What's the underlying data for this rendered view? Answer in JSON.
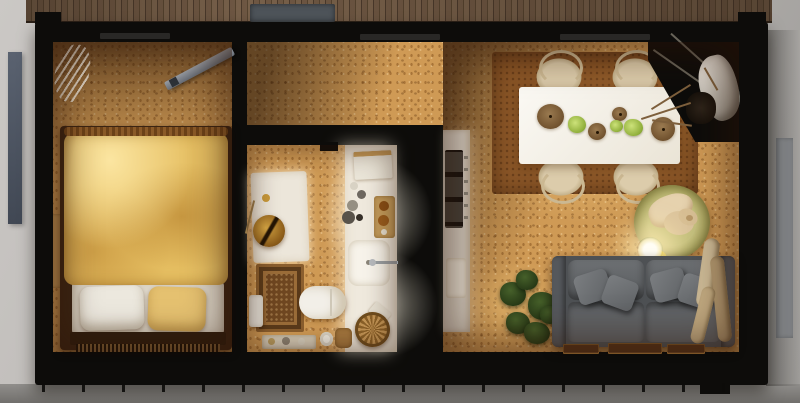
{
  "scene": {
    "type": "3d-floor-plan-top-down-render",
    "rooms": [
      {
        "id": "bedroom",
        "furniture": [
          "pampas-plant",
          "steel-beam",
          "nightstand",
          "double-bed",
          "duvet",
          "pillow-white",
          "pillow-yellow",
          "headboard",
          "slatted-bench"
        ]
      },
      {
        "id": "hallway",
        "furniture": []
      },
      {
        "id": "bathroom",
        "furniture": [
          "shower-vanity-panel",
          "gold-basin",
          "vanity-counter",
          "towel-stack",
          "accessory-jars",
          "bottle-tray",
          "sink",
          "faucet",
          "ornate-rug",
          "toilet",
          "pedal-bin",
          "soap-dish",
          "wicker-basket",
          "bath-bench",
          "paper-roll",
          "wicker-bin"
        ]
      },
      {
        "id": "living-dining",
        "furniture": [
          "kitchenette-counter",
          "cooktop",
          "kitchen-sink",
          "dining-rug",
          "dining-table",
          "wishbone-chairs",
          "bowls-and-greens",
          "dog-bed",
          "sleeping-dog",
          "floor-lamp",
          "sofa",
          "throw-pillows",
          "green-plant",
          "driftwood-decor",
          "dried-branches",
          "drapery",
          "floor-mats"
        ]
      }
    ],
    "exterior": [
      "wood-deck",
      "doormat",
      "fence-panel-left",
      "panel-right",
      "concrete-apron",
      "roof-batten-ticks"
    ]
  },
  "counts": {
    "dining_chairs": 4,
    "sofa_throw_pillows": 4,
    "table_items": 7,
    "floor_mats": 3
  },
  "palette": {
    "wall": "#0d0c0a",
    "floor": "#cf9a55",
    "rug": "#8a5627",
    "duvet": "#e6bf62",
    "sofa": "#4e5154",
    "gold": "#d9a945",
    "deck": "#63503e",
    "dogbed": "#b3ae6b",
    "ground": "#b8b5b2"
  },
  "bathroom": {
    "accessories": [
      {
        "name": "jar",
        "cls": "dot",
        "x": 350,
        "y": 182,
        "w": 8,
        "h": 8,
        "color": "#d8d2c4"
      },
      {
        "name": "jar",
        "cls": "dot",
        "x": 357,
        "y": 190,
        "w": 9,
        "h": 9,
        "color": "#6e6860"
      },
      {
        "name": "jar",
        "cls": "dot",
        "x": 347,
        "y": 200,
        "w": 11,
        "h": 11,
        "color": "#958f82"
      },
      {
        "name": "jar",
        "cls": "dot",
        "x": 342,
        "y": 211,
        "w": 13,
        "h": 13,
        "color": "#59534a"
      },
      {
        "name": "jar",
        "cls": "dot",
        "x": 356,
        "y": 214,
        "w": 7,
        "h": 7,
        "color": "#352f28"
      }
    ],
    "bench_items": [
      {
        "name": "bottle",
        "cls": "dot",
        "x": 268,
        "y": 338,
        "w": 7,
        "h": 7,
        "color": "#b89c60"
      },
      {
        "name": "bottle",
        "cls": "dot",
        "x": 282,
        "y": 337,
        "w": 8,
        "h": 8,
        "color": "#8a8072"
      },
      {
        "name": "bottle",
        "cls": "dot",
        "x": 298,
        "y": 338,
        "w": 7,
        "h": 7,
        "color": "#d8d2c2"
      }
    ]
  },
  "dining": {
    "chairs": [
      {
        "name": "wishbone-chair",
        "cls": "chair chair-t",
        "x": 536,
        "y": 58,
        "w": 46,
        "h": 38
      },
      {
        "name": "wishbone-chair",
        "cls": "chair chair-t",
        "x": 612,
        "y": 58,
        "w": 46,
        "h": 38
      },
      {
        "name": "wishbone-chair",
        "cls": "chair chair-b",
        "x": 538,
        "y": 158,
        "w": 46,
        "h": 38
      },
      {
        "name": "wishbone-chair",
        "cls": "chair chair-b",
        "x": 613,
        "y": 158,
        "w": 46,
        "h": 38
      }
    ],
    "tableware": [
      {
        "name": "pendant-bowl",
        "cls": "bowl",
        "x": 537,
        "y": 104,
        "w": 27,
        "h": 25
      },
      {
        "name": "greens",
        "cls": "greens",
        "x": 568,
        "y": 116,
        "w": 18,
        "h": 17
      },
      {
        "name": "small-bowl",
        "cls": "bowl",
        "x": 588,
        "y": 123,
        "w": 18,
        "h": 17
      },
      {
        "name": "small-bowl",
        "cls": "bowl",
        "x": 612,
        "y": 107,
        "w": 15,
        "h": 14
      },
      {
        "name": "greens",
        "cls": "greens",
        "x": 610,
        "y": 120,
        "w": 13,
        "h": 12
      },
      {
        "name": "greens",
        "cls": "greens",
        "x": 624,
        "y": 119,
        "w": 19,
        "h": 17
      },
      {
        "name": "pendant-bowl",
        "cls": "bowl",
        "x": 651,
        "y": 117,
        "w": 24,
        "h": 24
      }
    ]
  },
  "sofa": {
    "pillows": [
      {
        "name": "throw-pillow",
        "cls": "tpillow",
        "x": 24,
        "y": 16,
        "w": 34,
        "h": 30,
        "rot": -18
      },
      {
        "name": "throw-pillow",
        "cls": "tpillow",
        "x": 52,
        "y": 22,
        "w": 32,
        "h": 30,
        "rot": 20
      },
      {
        "name": "throw-pillow",
        "cls": "tpillow",
        "x": 100,
        "y": 14,
        "w": 34,
        "h": 30,
        "rot": -15
      },
      {
        "name": "throw-pillow",
        "cls": "tpillow",
        "x": 128,
        "y": 20,
        "w": 32,
        "h": 30,
        "rot": 18
      }
    ]
  },
  "living": {
    "plant_tufts": [
      {
        "name": "leaf-tuft",
        "cls": "leafball",
        "x": 500,
        "y": 282,
        "w": 26,
        "h": 24
      },
      {
        "name": "leaf-tuft",
        "cls": "leafball",
        "x": 516,
        "y": 270,
        "w": 22,
        "h": 20
      },
      {
        "name": "leaf-tuft",
        "cls": "leafball",
        "x": 528,
        "y": 292,
        "w": 30,
        "h": 28
      },
      {
        "name": "leaf-tuft",
        "cls": "leafball",
        "x": 506,
        "y": 312,
        "w": 24,
        "h": 22
      },
      {
        "name": "leaf-tuft",
        "cls": "leafball",
        "x": 524,
        "y": 322,
        "w": 26,
        "h": 22
      },
      {
        "name": "leaf-tuft",
        "cls": "leafball",
        "x": 540,
        "y": 306,
        "w": 20,
        "h": 18
      }
    ],
    "floor_mats": [
      {
        "name": "floor-mat",
        "cls": "mat",
        "x": 563,
        "y": 344,
        "w": 36,
        "h": 10
      },
      {
        "name": "floor-mat",
        "cls": "mat",
        "x": 608,
        "y": 343,
        "w": 54,
        "h": 11
      },
      {
        "name": "floor-mat",
        "cls": "mat",
        "x": 667,
        "y": 344,
        "w": 38,
        "h": 10
      }
    ],
    "branches": [
      {
        "name": "dried-branch",
        "cls": "branch",
        "x": 640,
        "y": 110,
        "w": 52,
        "h": 2,
        "rot": -18
      },
      {
        "name": "dried-branch",
        "cls": "branch",
        "x": 648,
        "y": 96,
        "w": 46,
        "h": 2,
        "rot": -32
      },
      {
        "name": "dried-branch",
        "cls": "branch",
        "x": 652,
        "y": 122,
        "w": 40,
        "h": 2,
        "rot": 8
      },
      {
        "name": "dried-branch",
        "cls": "branch",
        "x": 698,
        "y": 78,
        "w": 26,
        "h": 2,
        "rot": 60
      }
    ],
    "cords": [
      {
        "name": "pendant-cord",
        "cls": "cord",
        "x": 648,
        "y": 66,
        "w": 60,
        "h": 2,
        "rot": 35
      },
      {
        "name": "pendant-cord",
        "cls": "cord",
        "x": 662,
        "y": 56,
        "w": 70,
        "h": 2,
        "rot": 42
      }
    ]
  },
  "sills": [
    {
      "name": "window-sill",
      "cls": "sill",
      "x": 100,
      "y": 33,
      "w": 70,
      "h": 6
    },
    {
      "name": "window-sill",
      "cls": "sill",
      "x": 360,
      "y": 34,
      "w": 80,
      "h": 6
    },
    {
      "name": "window-sill",
      "cls": "sill",
      "x": 560,
      "y": 34,
      "w": 90,
      "h": 6
    }
  ]
}
